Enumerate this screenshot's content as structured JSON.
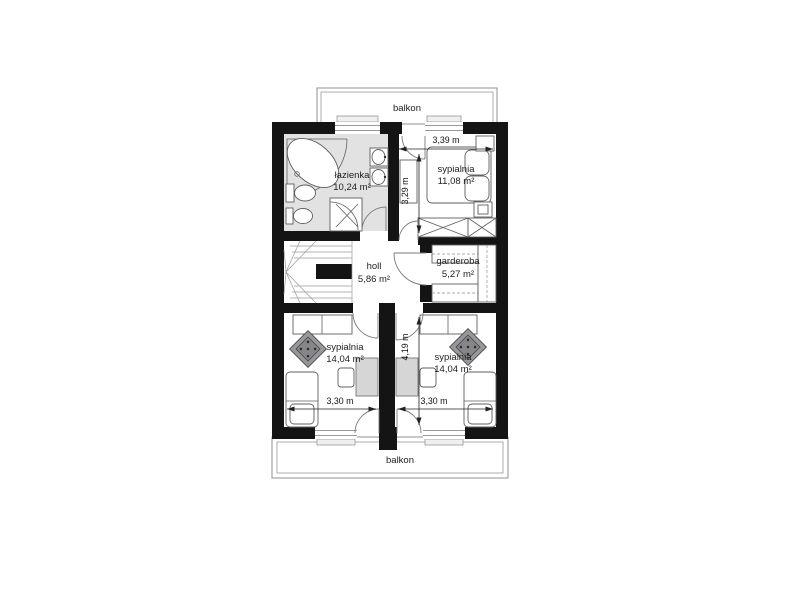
{
  "plan_title": "floor-plan",
  "colors": {
    "wall": "#141414",
    "bathfill": "#e2e2e2",
    "line": "#5f5f5f",
    "balcony": "#9a9a9a"
  },
  "rooms": [
    {
      "name": "łazienka",
      "area": "10,24 m²"
    },
    {
      "name": "sypialnia",
      "area": "11,08 m²"
    },
    {
      "name": "holl",
      "area": "5,86 m²"
    },
    {
      "name": "garderoba",
      "area": "5,27 m²"
    },
    {
      "name": "sypialnia",
      "area": "14,04 m²"
    },
    {
      "name": "sypialnia",
      "area": "14,04 m²"
    }
  ],
  "balconies": {
    "top": "balkon",
    "bottom": "balkon"
  },
  "dimensions": [
    {
      "label": "3,39 m"
    },
    {
      "label": "3,29 m"
    },
    {
      "label": "4,19 m"
    },
    {
      "label": "3,30 m"
    },
    {
      "label": "3,30 m"
    }
  ]
}
